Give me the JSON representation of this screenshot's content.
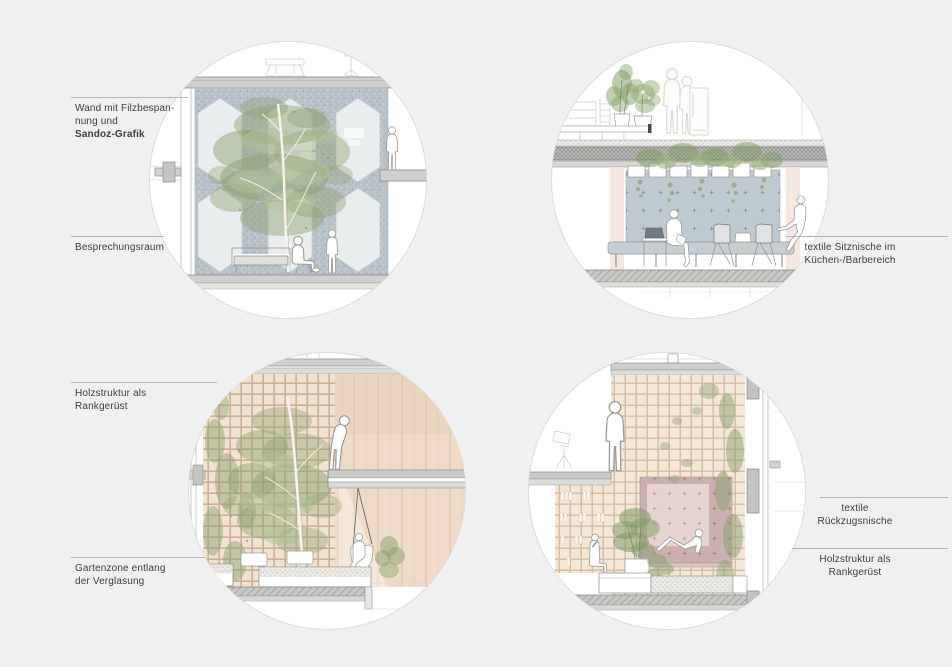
{
  "page": {
    "background": "#eff0f1",
    "type": "architectural interior section vignettes, 4 circular details"
  },
  "palette": {
    "circle_bg": "#ffffff",
    "circle_ring": "#dddddb",
    "felt_wall": "#b9c2c9",
    "textile_blue": "#bfc9d0",
    "textile_pink_outer": "#cab1b0",
    "textile_pink_inner": "#e6d4d0",
    "wood_trellis": "#f1e3d2",
    "trellis_line": "#cdb097",
    "foliage_green": "#8ea171",
    "slab_grey": "#cfd0cd",
    "label_text": "#3d3d3d",
    "leader_line": "#b4b4b0"
  },
  "annotations": {
    "felt_wall": {
      "line1": "Wand mit Filzbespan-",
      "line2": "nung und",
      "line3": "Sandoz-Grafik"
    },
    "meeting_room": {
      "line1": "Besprechungsraum"
    },
    "seating_niche": {
      "line1": "textile Sitznische im",
      "line2": "Küchen-/Barbereich"
    },
    "wood_structure_bl": {
      "line1": "Holzstruktur als",
      "line2": "Rankgerüst"
    },
    "garden_zone": {
      "line1": "Gartenzone entlang",
      "line2": "der Verglasung"
    },
    "retreat_niche": {
      "line1": "textile",
      "line2": "Rückzugsnische"
    },
    "wood_structure_br": {
      "line1": "Holzstruktur als",
      "line2": "Rankgerüst"
    }
  }
}
